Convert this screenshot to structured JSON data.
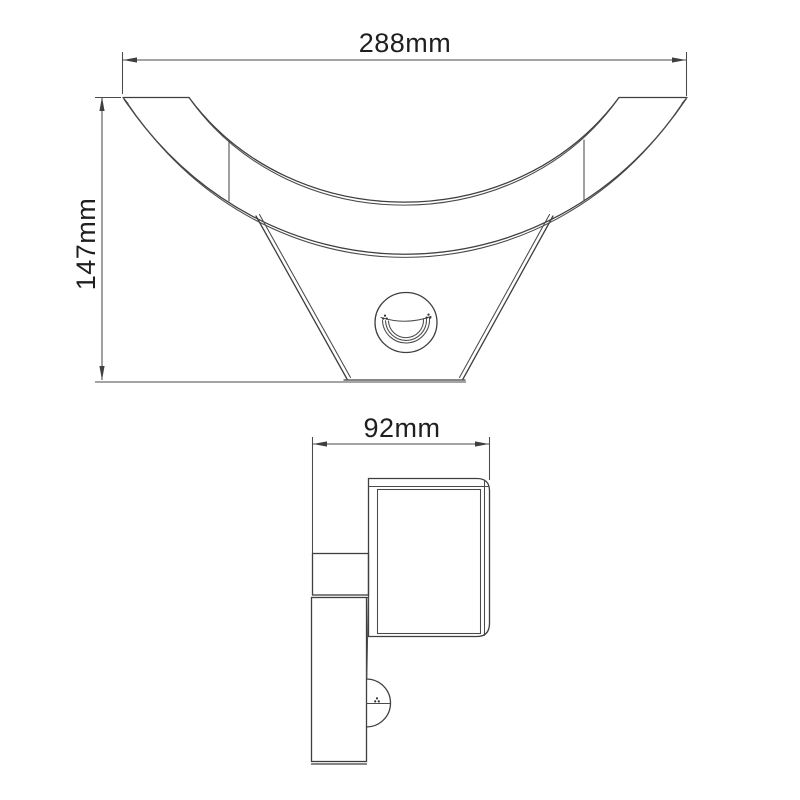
{
  "colors": {
    "background": "#ffffff",
    "part_line": "#3f3f3f",
    "dimension_line": "#4a4a4a",
    "label_text": "#1f1f1f"
  },
  "front_view": {
    "width_label": "288mm",
    "height_label": "147mm"
  },
  "side_view": {
    "depth_label": "92mm"
  }
}
